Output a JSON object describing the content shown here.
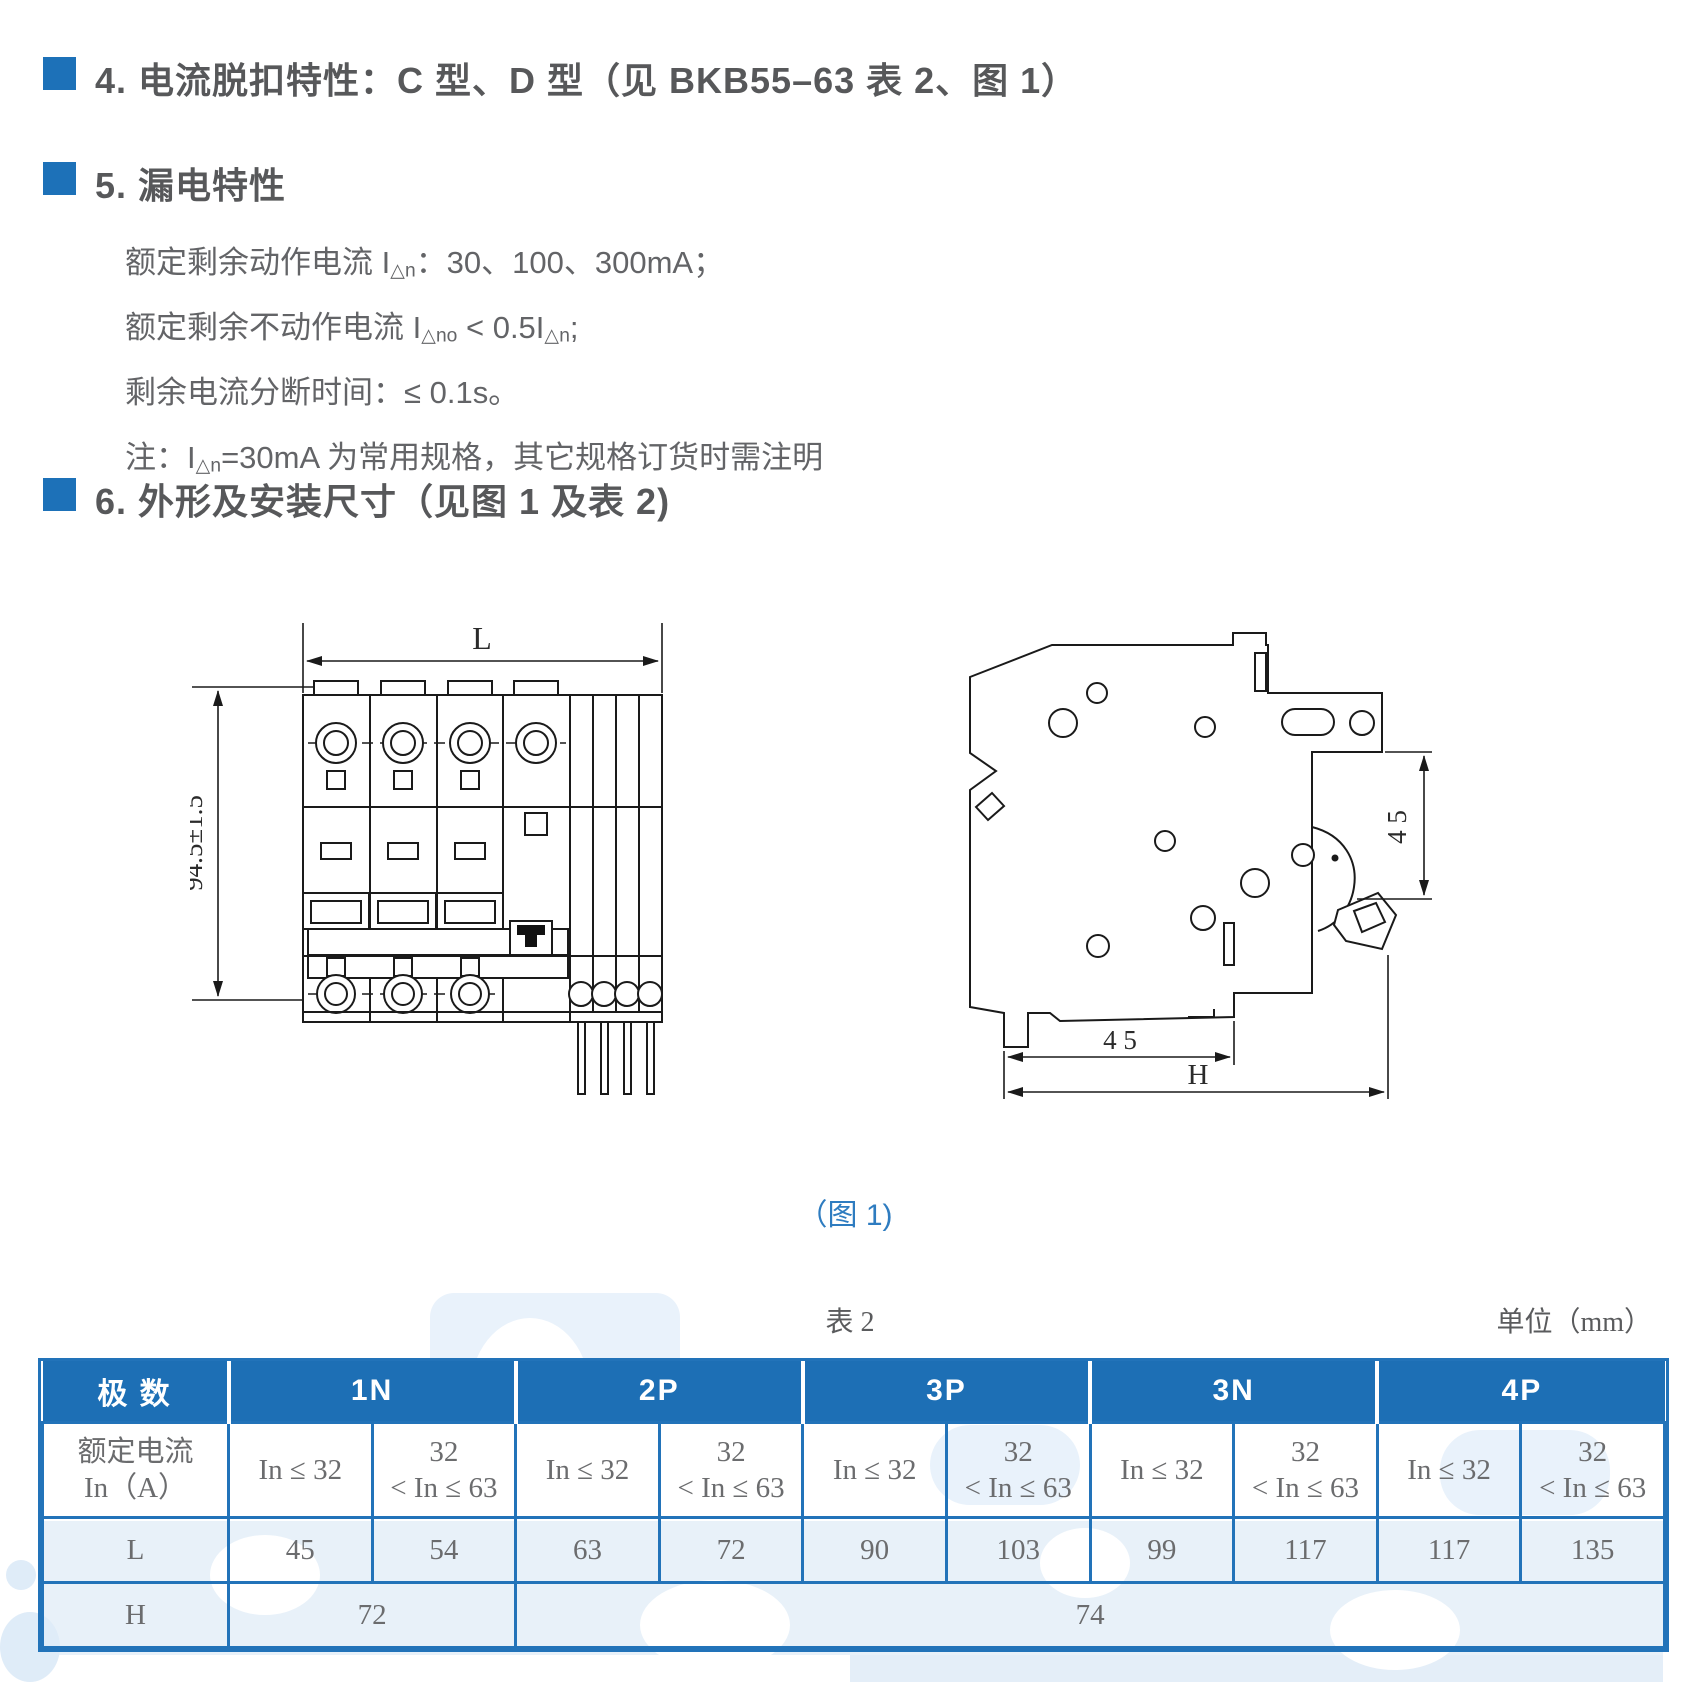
{
  "colors": {
    "accent_blue": "#1d71b8",
    "table_header_blue": "#1d6fb5",
    "table_border_blue": "#2273b9",
    "caption_blue": "#2e7cc0",
    "heading_gray": "#57585a",
    "body_gray": "#636467",
    "watermark_blue": "#e9f2fb"
  },
  "sections": {
    "s4": {
      "title": "4. 电流脱扣特性：C 型、D 型（见 BKB55–63 表 2、图 1）"
    },
    "s5": {
      "title": "5. 漏电特性",
      "lines": [
        {
          "pre": "额定剩余动作电流 I",
          "sub": "△n",
          "mid": "：30、100、300mA；"
        },
        {
          "pre": "额定剩余不动作电流 I",
          "sub": "△no",
          "mid": " < 0.5I",
          "sub2": "△n",
          "post": ";"
        },
        {
          "pre": "剩余电流分断时间：≤ 0.1s。"
        },
        {
          "pre": "注：I",
          "sub": "△n",
          "mid": "=30mA 为常用规格，其它规格订货时需注明"
        }
      ]
    },
    "s6": {
      "title": "6. 外形及安装尺寸（见图 1 及表 2)"
    }
  },
  "figure": {
    "caption": "（图 1)",
    "front_view": {
      "width_label": "L",
      "height_label": "94.5±1.5"
    },
    "side_view": {
      "depth_label": "4 5",
      "bottom_width_label": "4 5",
      "overall_label": "H"
    }
  },
  "table2": {
    "caption": "表 2",
    "unit": "单位（mm）",
    "corner": "极 数",
    "groups": [
      "1N",
      "2P",
      "3P",
      "3N",
      "4P"
    ],
    "current_label_1": "额定电流",
    "current_label_2": "In（A）",
    "sub_low": "In ≤ 32",
    "sub_high_1": "32",
    "sub_high_2": "< In ≤ 63",
    "row_L": {
      "label": "L",
      "values": [
        "45",
        "54",
        "63",
        "72",
        "90",
        "103",
        "99",
        "117",
        "117",
        "135"
      ]
    },
    "row_H": {
      "label": "H",
      "values": [
        "72",
        "74"
      ]
    }
  }
}
